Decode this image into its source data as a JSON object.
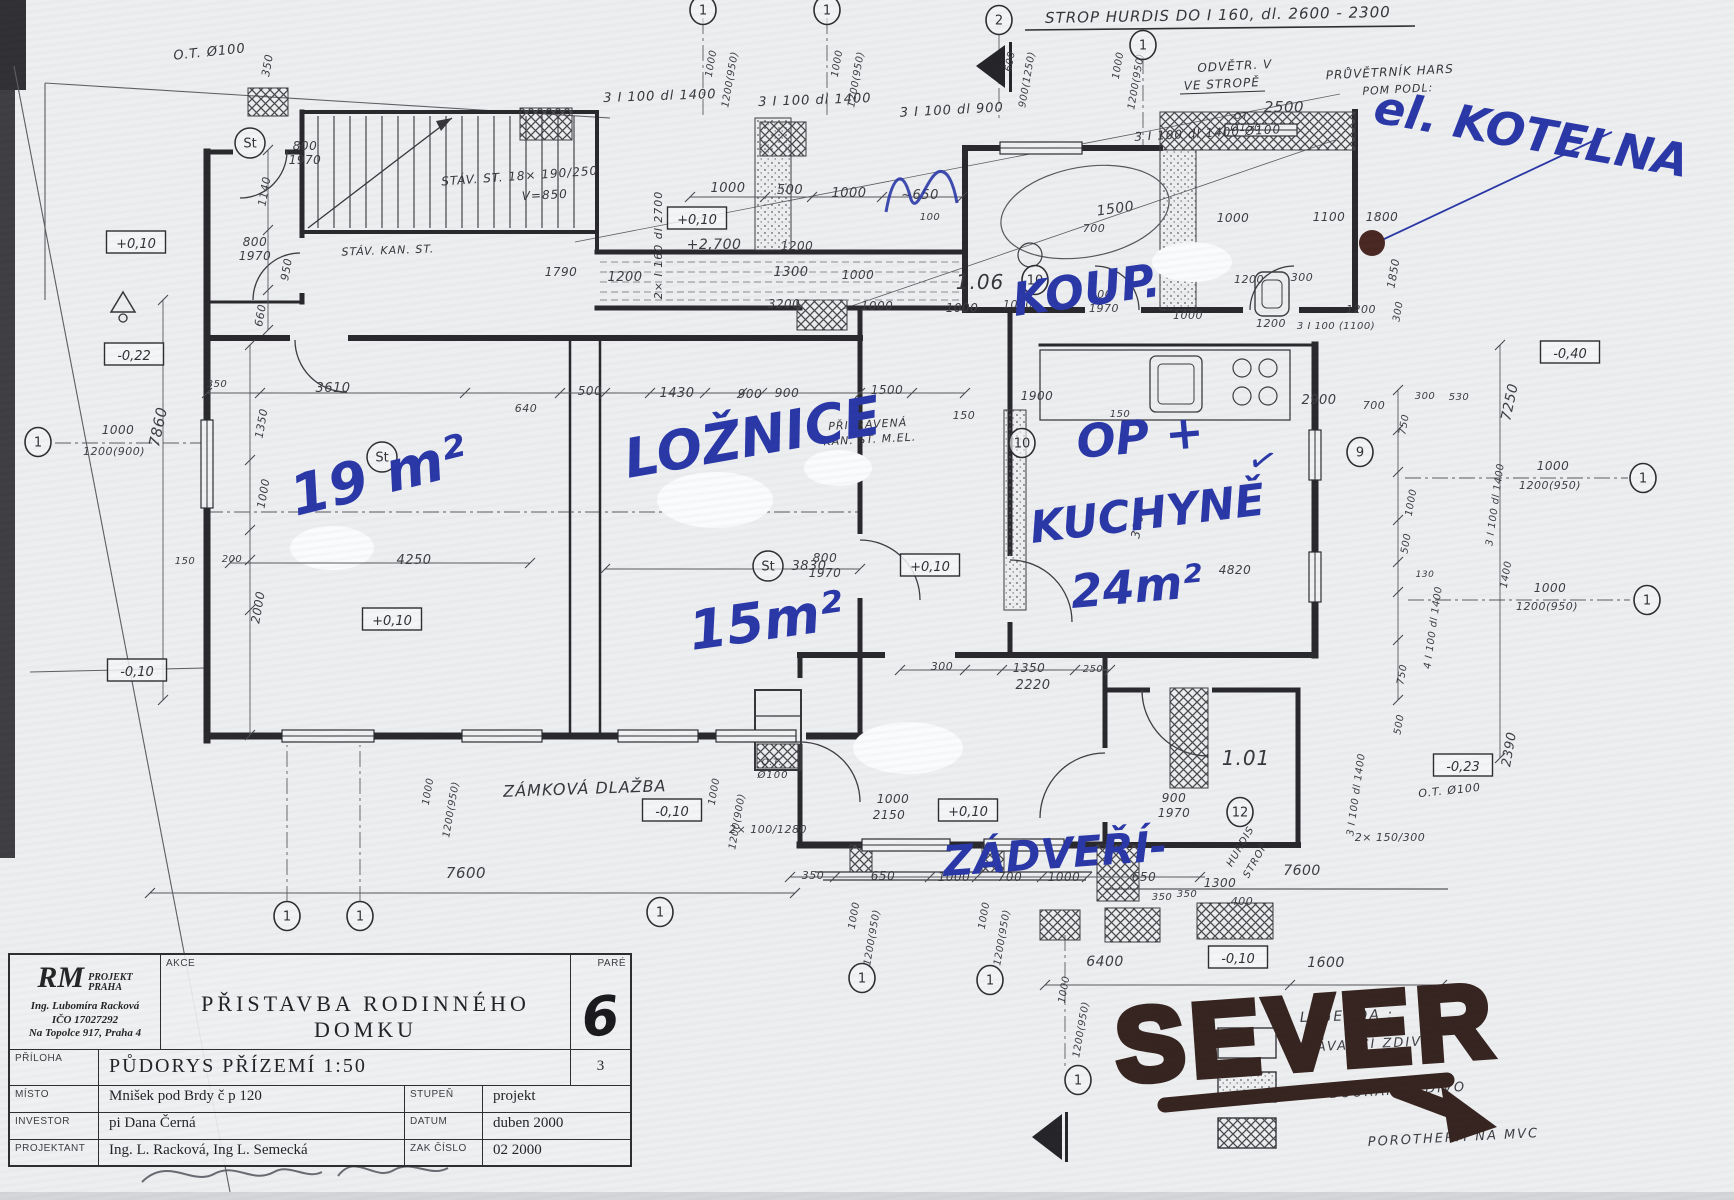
{
  "title_block": {
    "brand_r": "RM",
    "brand_top": "PROJEKT",
    "brand_bottom": "PRAHA",
    "logo_line1": "Ing. Lubomíra Racková",
    "logo_line2": "IČO 17027292",
    "logo_line3": "Na Topolce 917, Praha 4",
    "akce_label": "AKCE",
    "akce_value": "PŘISTAVBA RODINNÉHO DOMKU",
    "pare_label": "PARÉ",
    "pare_value": "6",
    "priloha_label": "PŘÍLOHA",
    "priloha_value": "PŮDORYS PŘÍZEMÍ 1:50",
    "priloha_number": "3",
    "misto_label": "MÍSTO",
    "misto_value": "Mnišek pod Brdy č p 120",
    "stupen_label": "STUPEŇ",
    "stupen_value": "projekt",
    "investor_label": "INVESTOR",
    "investor_value": "pi Dana Černá",
    "datum_label": "DATUM",
    "datum_value": "duben 2000",
    "projektant_label": "PROJEKTANT",
    "projektant_value": "Ing. L. Racková, Ing L. Semecká",
    "zakcislo_label": "ZAK ČÍSLO",
    "zakcislo_value": "02 2000"
  },
  "marker_black": {
    "text": "SEVER",
    "color": "#33211d"
  },
  "handwritten_blue": {
    "color": "#2735a6",
    "items": [
      {
        "t": "el. KOTELNA",
        "x": 1372,
        "y": 122,
        "r": 10,
        "s": 46
      },
      {
        "t": "KOUP.",
        "x": 1015,
        "y": 316,
        "r": -8,
        "s": 46
      },
      {
        "t": "LOŽNICE",
        "x": 628,
        "y": 478,
        "r": -10,
        "s": 54
      },
      {
        "t": "15m²",
        "x": 692,
        "y": 650,
        "r": -8,
        "s": 54
      },
      {
        "t": "19 m²",
        "x": 296,
        "y": 516,
        "r": -14,
        "s": 56
      },
      {
        "t": "OP +",
        "x": 1078,
        "y": 458,
        "r": -5,
        "s": 46
      },
      {
        "t": "KUCHYNĚ",
        "x": 1032,
        "y": 543,
        "r": -7,
        "s": 44
      },
      {
        "t": "24m²",
        "x": 1072,
        "y": 608,
        "r": -5,
        "s": 46
      },
      {
        "t": "ZÁDVEŘÍ-",
        "x": 944,
        "y": 876,
        "r": -4,
        "s": 42
      },
      {
        "t": "✓",
        "x": 1246,
        "y": 468,
        "r": 15,
        "s": 34
      }
    ]
  },
  "legend": {
    "title": "LEGENDA :",
    "items": [
      {
        "label": "STÁVAJÍCÍ ZDIVO",
        "swatch": "empty"
      },
      {
        "label": "BOURANÉ ZDIVO",
        "swatch": "dots"
      },
      {
        "label": "POROTHERM NA MVC",
        "swatch": "hatch"
      }
    ]
  },
  "st_markers": {
    "label": "St",
    "positions": [
      [
        250,
        143
      ],
      [
        382,
        457
      ],
      [
        768,
        566
      ]
    ]
  },
  "axis_markers": [
    {
      "n": "1",
      "x": 703,
      "y": 10
    },
    {
      "n": "1",
      "x": 827,
      "y": 10
    },
    {
      "n": "2",
      "x": 999,
      "y": 20
    },
    {
      "n": "1",
      "x": 1143,
      "y": 45
    },
    {
      "n": "1",
      "x": 38,
      "y": 442
    },
    {
      "n": "1",
      "x": 1643,
      "y": 478
    },
    {
      "n": "1",
      "x": 1647,
      "y": 600
    },
    {
      "n": "10",
      "x": 1035,
      "y": 280
    },
    {
      "n": "10",
      "x": 1022,
      "y": 443
    },
    {
      "n": "9",
      "x": 1360,
      "y": 452
    },
    {
      "n": "12",
      "x": 1240,
      "y": 812
    },
    {
      "n": "1",
      "x": 287,
      "y": 916
    },
    {
      "n": "1",
      "x": 360,
      "y": 916
    },
    {
      "n": "1",
      "x": 660,
      "y": 912
    },
    {
      "n": "1",
      "x": 862,
      "y": 978
    },
    {
      "n": "1",
      "x": 990,
      "y": 980
    },
    {
      "n": "1",
      "x": 1078,
      "y": 1080
    }
  ],
  "levels": [
    {
      "t": "+0,10",
      "x": 136,
      "y": 244
    },
    {
      "t": "+0,10",
      "x": 697,
      "y": 220
    },
    {
      "t": "+0,10",
      "x": 392,
      "y": 621
    },
    {
      "t": "+0,10",
      "x": 930,
      "y": 567
    },
    {
      "t": "+0,10",
      "x": 968,
      "y": 812
    },
    {
      "t": "-0,22",
      "x": 134,
      "y": 356
    },
    {
      "t": "-0,10",
      "x": 137,
      "y": 672
    },
    {
      "t": "-0,10",
      "x": 672,
      "y": 812
    },
    {
      "t": "-0,10",
      "x": 1238,
      "y": 959
    },
    {
      "t": "-0,40",
      "x": 1570,
      "y": 354
    },
    {
      "t": "-0,23",
      "x": 1463,
      "y": 767
    }
  ],
  "notes": [
    {
      "t": "STROP HURDIS DO I 160, dl. 2600 - 2300",
      "x": 1218,
      "y": 20,
      "r": -1,
      "s": 15
    },
    {
      "t": "ODVĚTR. V",
      "x": 1235,
      "y": 70,
      "r": -3,
      "s": 12
    },
    {
      "t": "VE STROPĚ",
      "x": 1222,
      "y": 88,
      "r": -3,
      "s": 12
    },
    {
      "t": "PRŮVĚTRNÍK HARS",
      "x": 1390,
      "y": 76,
      "r": -3,
      "s": 12
    },
    {
      "t": "POM PODL:",
      "x": 1398,
      "y": 93,
      "r": -3,
      "s": 11
    },
    {
      "t": "3 I 100 dl 1400 Ø100",
      "x": 1208,
      "y": 137,
      "r": -3,
      "s": 12
    },
    {
      "t": "3 I 100 dl 1400",
      "x": 660,
      "y": 100,
      "r": -2,
      "s": 13
    },
    {
      "t": "3 I 100 dl 1400",
      "x": 815,
      "y": 104,
      "r": -2,
      "s": 13
    },
    {
      "t": "3 I 100 dl 900",
      "x": 952,
      "y": 114,
      "r": -3,
      "s": 13
    },
    {
      "t": "O.T. Ø100",
      "x": 210,
      "y": 56,
      "r": -6,
      "s": 13
    },
    {
      "t": "OT:",
      "x": 1243,
      "y": 119,
      "r": 0,
      "s": 9
    },
    {
      "t": "Ø150",
      "x": 1246,
      "y": 131,
      "r": 0,
      "s": 10
    },
    {
      "t": "STÁV. KAN. ST.",
      "x": 388,
      "y": 254,
      "r": -2,
      "s": 11
    },
    {
      "t": "STÁV. ST. 18× 190/250",
      "x": 520,
      "y": 180,
      "r": -4,
      "s": 12
    },
    {
      "t": "V=850",
      "x": 545,
      "y": 199,
      "r": -3,
      "s": 12
    },
    {
      "t": "2× I 160 dl 2700",
      "x": 662,
      "y": 245,
      "r": -90,
      "s": 11
    },
    {
      "t": "PŘIPRAVENÁ",
      "x": 868,
      "y": 428,
      "r": -3,
      "s": 11
    },
    {
      "t": "KAN. ST. M.EL.",
      "x": 870,
      "y": 443,
      "r": -3,
      "s": 11
    },
    {
      "t": "ZÁMKOVÁ DLAŽBA",
      "x": 585,
      "y": 794,
      "r": -2,
      "s": 16
    },
    {
      "t": "1.06",
      "x": 980,
      "y": 289,
      "r": 0,
      "s": 20
    },
    {
      "t": "1.01",
      "x": 1246,
      "y": 765,
      "r": 0,
      "s": 20
    },
    {
      "t": "HURDIS",
      "x": 1243,
      "y": 848,
      "r": -60,
      "s": 10
    },
    {
      "t": "STROP",
      "x": 1258,
      "y": 862,
      "r": -60,
      "s": 10
    },
    {
      "t": "O.T.",
      "x": 772,
      "y": 765,
      "r": 0,
      "s": 9
    },
    {
      "t": "Ø100",
      "x": 773,
      "y": 778,
      "r": 0,
      "s": 10
    },
    {
      "t": "O.T. Ø100",
      "x": 1450,
      "y": 794,
      "r": -6,
      "s": 11
    }
  ],
  "dimensions": [
    {
      "t": "350",
      "x": 271,
      "y": 66,
      "r": -80,
      "s": 11
    },
    {
      "t": "800",
      "x": 305,
      "y": 150,
      "r": 0,
      "s": 12
    },
    {
      "t": "1970",
      "x": 305,
      "y": 164,
      "r": 0,
      "s": 12
    },
    {
      "t": "1140",
      "x": 268,
      "y": 192,
      "r": -80,
      "s": 11
    },
    {
      "t": "800",
      "x": 255,
      "y": 246,
      "r": 0,
      "s": 12
    },
    {
      "t": "1970",
      "x": 255,
      "y": 260,
      "r": 0,
      "s": 12
    },
    {
      "t": "950",
      "x": 290,
      "y": 270,
      "r": -80,
      "s": 11
    },
    {
      "t": "660",
      "x": 264,
      "y": 316,
      "r": -80,
      "s": 11
    },
    {
      "t": "1000",
      "x": 714,
      "y": 64,
      "r": -80,
      "s": 10
    },
    {
      "t": "1200(950)",
      "x": 733,
      "y": 80,
      "r": -80,
      "s": 10
    },
    {
      "t": "1000",
      "x": 840,
      "y": 64,
      "r": -80,
      "s": 10
    },
    {
      "t": "1200(950)",
      "x": 859,
      "y": 80,
      "r": -80,
      "s": 10
    },
    {
      "t": "600",
      "x": 1013,
      "y": 62,
      "r": -80,
      "s": 10
    },
    {
      "t": "900(1250)",
      "x": 1030,
      "y": 80,
      "r": -80,
      "s": 10
    },
    {
      "t": "1000",
      "x": 1121,
      "y": 66,
      "r": -80,
      "s": 10
    },
    {
      "t": "1200(950)",
      "x": 1139,
      "y": 82,
      "r": -80,
      "s": 10
    },
    {
      "t": "2500",
      "x": 1284,
      "y": 112,
      "r": 0,
      "s": 15
    },
    {
      "t": "1000",
      "x": 728,
      "y": 192,
      "r": 0,
      "s": 13
    },
    {
      "t": "500",
      "x": 790,
      "y": 194,
      "r": 0,
      "s": 13
    },
    {
      "t": "1000",
      "x": 849,
      "y": 197,
      "r": 0,
      "s": 13
    },
    {
      "t": "~650",
      "x": 920,
      "y": 199,
      "r": 0,
      "s": 13
    },
    {
      "t": "100",
      "x": 930,
      "y": 220,
      "r": 0,
      "s": 10
    },
    {
      "t": "+2,700",
      "x": 714,
      "y": 249,
      "r": 0,
      "s": 14
    },
    {
      "t": "1790",
      "x": 561,
      "y": 276,
      "r": 0,
      "s": 12
    },
    {
      "t": "1200",
      "x": 625,
      "y": 281,
      "r": 0,
      "s": 13
    },
    {
      "t": "1300",
      "x": 791,
      "y": 276,
      "r": 0,
      "s": 13
    },
    {
      "t": "1000",
      "x": 858,
      "y": 279,
      "r": 0,
      "s": 12
    },
    {
      "t": "1200",
      "x": 797,
      "y": 250,
      "r": 0,
      "s": 12
    },
    {
      "t": "3200",
      "x": 784,
      "y": 308,
      "r": 0,
      "s": 12
    },
    {
      "t": "1000",
      "x": 877,
      "y": 310,
      "r": 0,
      "s": 12
    },
    {
      "t": "1000",
      "x": 962,
      "y": 312,
      "r": 0,
      "s": 12
    },
    {
      "t": "1500",
      "x": 1116,
      "y": 213,
      "r": -8,
      "s": 14
    },
    {
      "t": "700",
      "x": 1094,
      "y": 232,
      "r": 0,
      "s": 11
    },
    {
      "t": "1000",
      "x": 1233,
      "y": 222,
      "r": 0,
      "s": 12
    },
    {
      "t": "1100",
      "x": 1329,
      "y": 221,
      "r": 0,
      "s": 12
    },
    {
      "t": "1800",
      "x": 1382,
      "y": 221,
      "r": 0,
      "s": 12
    },
    {
      "t": "1850",
      "x": 1397,
      "y": 274,
      "r": -80,
      "s": 11
    },
    {
      "t": "600",
      "x": 1101,
      "y": 298,
      "r": 0,
      "s": 11
    },
    {
      "t": "1970",
      "x": 1104,
      "y": 312,
      "r": 0,
      "s": 11
    },
    {
      "t": "1000",
      "x": 1018,
      "y": 308,
      "r": 0,
      "s": 11
    },
    {
      "t": "1000",
      "x": 1188,
      "y": 319,
      "r": 0,
      "s": 11
    },
    {
      "t": "1200",
      "x": 1271,
      "y": 327,
      "r": 0,
      "s": 11
    },
    {
      "t": "1200",
      "x": 1249,
      "y": 283,
      "r": 0,
      "s": 11
    },
    {
      "t": "300",
      "x": 1302,
      "y": 281,
      "r": 0,
      "s": 11
    },
    {
      "t": "1200",
      "x": 1361,
      "y": 313,
      "r": 0,
      "s": 11
    },
    {
      "t": "3 I 100 (1100)",
      "x": 1336,
      "y": 329,
      "r": 0,
      "s": 10
    },
    {
      "t": "300",
      "x": 1401,
      "y": 312,
      "r": -80,
      "s": 10
    },
    {
      "t": "900",
      "x": 787,
      "y": 397,
      "r": 0,
      "s": 12
    },
    {
      "t": "1500",
      "x": 887,
      "y": 394,
      "r": 0,
      "s": 12
    },
    {
      "t": "150",
      "x": 964,
      "y": 419,
      "r": 0,
      "s": 11
    },
    {
      "t": "350",
      "x": 217,
      "y": 387,
      "r": 0,
      "s": 10
    },
    {
      "t": "3610",
      "x": 333,
      "y": 392,
      "r": 0,
      "s": 13
    },
    {
      "t": "640",
      "x": 526,
      "y": 412,
      "r": 0,
      "s": 11
    },
    {
      "t": "500",
      "x": 590,
      "y": 395,
      "r": 0,
      "s": 12
    },
    {
      "t": "1430",
      "x": 677,
      "y": 397,
      "r": 0,
      "s": 13
    },
    {
      "t": "900",
      "x": 750,
      "y": 398,
      "r": 0,
      "s": 12
    },
    {
      "t": "7860",
      "x": 163,
      "y": 428,
      "r": -78,
      "s": 15
    },
    {
      "t": "1350",
      "x": 265,
      "y": 424,
      "r": -80,
      "s": 11
    },
    {
      "t": "1000",
      "x": 267,
      "y": 494,
      "r": -80,
      "s": 11
    },
    {
      "t": "1000",
      "x": 118,
      "y": 434,
      "r": 0,
      "s": 12
    },
    {
      "t": "1200(900)",
      "x": 114,
      "y": 455,
      "r": 0,
      "s": 11
    },
    {
      "t": "150",
      "x": 185,
      "y": 564,
      "r": 0,
      "s": 10
    },
    {
      "t": "200",
      "x": 232,
      "y": 562,
      "r": 0,
      "s": 10
    },
    {
      "t": "2000",
      "x": 262,
      "y": 608,
      "r": -80,
      "s": 12
    },
    {
      "t": "4250",
      "x": 414,
      "y": 564,
      "r": 0,
      "s": 13
    },
    {
      "t": "3830",
      "x": 809,
      "y": 570,
      "r": 0,
      "s": 13
    },
    {
      "t": "800",
      "x": 825,
      "y": 562,
      "r": 0,
      "s": 12
    },
    {
      "t": "1970",
      "x": 825,
      "y": 577,
      "r": 0,
      "s": 12
    },
    {
      "t": "1900",
      "x": 1037,
      "y": 400,
      "r": 0,
      "s": 12
    },
    {
      "t": "150",
      "x": 1120,
      "y": 417,
      "r": 0,
      "s": 10
    },
    {
      "t": "2900",
      "x": 1319,
      "y": 404,
      "r": 0,
      "s": 13
    },
    {
      "t": "700",
      "x": 1374,
      "y": 409,
      "r": 0,
      "s": 11
    },
    {
      "t": "3000",
      "x": 1142,
      "y": 523,
      "r": -80,
      "s": 12
    },
    {
      "t": "4820",
      "x": 1235,
      "y": 574,
      "r": 0,
      "s": 12
    },
    {
      "t": "300",
      "x": 1425,
      "y": 399,
      "r": 0,
      "s": 10
    },
    {
      "t": "530",
      "x": 1459,
      "y": 400,
      "r": 0,
      "s": 10
    },
    {
      "t": "750",
      "x": 1407,
      "y": 425,
      "r": -80,
      "s": 10
    },
    {
      "t": "1000",
      "x": 1414,
      "y": 503,
      "r": -80,
      "s": 10
    },
    {
      "t": "500",
      "x": 1409,
      "y": 544,
      "r": -80,
      "s": 10
    },
    {
      "t": "130",
      "x": 1425,
      "y": 577,
      "r": 0,
      "s": 9
    },
    {
      "t": "1400",
      "x": 1509,
      "y": 575,
      "r": -80,
      "s": 10
    },
    {
      "t": "7250",
      "x": 1514,
      "y": 403,
      "r": -78,
      "s": 14
    },
    {
      "t": "1000",
      "x": 1553,
      "y": 470,
      "r": 0,
      "s": 12
    },
    {
      "t": "1200(950)",
      "x": 1550,
      "y": 489,
      "r": 0,
      "s": 11
    },
    {
      "t": "1000",
      "x": 1550,
      "y": 592,
      "r": 0,
      "s": 12
    },
    {
      "t": "1200(950)",
      "x": 1547,
      "y": 610,
      "r": 0,
      "s": 11
    },
    {
      "t": "3 I 100 dl 1400",
      "x": 1498,
      "y": 505,
      "r": -82,
      "s": 10
    },
    {
      "t": "4 I 100 dl 1400",
      "x": 1436,
      "y": 628,
      "r": -82,
      "s": 10
    },
    {
      "t": "750",
      "x": 1405,
      "y": 675,
      "r": -80,
      "s": 10
    },
    {
      "t": "500",
      "x": 1402,
      "y": 725,
      "r": -80,
      "s": 10
    },
    {
      "t": "2390",
      "x": 1513,
      "y": 750,
      "r": -80,
      "s": 13
    },
    {
      "t": "2× 150/300",
      "x": 1390,
      "y": 841,
      "r": 0,
      "s": 11
    },
    {
      "t": "3 I 100 dl 1400",
      "x": 1359,
      "y": 795,
      "r": -82,
      "s": 10
    },
    {
      "t": "900",
      "x": 1174,
      "y": 802,
      "r": 0,
      "s": 12
    },
    {
      "t": "1970",
      "x": 1174,
      "y": 817,
      "r": 0,
      "s": 12
    },
    {
      "t": "1300",
      "x": 1220,
      "y": 887,
      "r": 0,
      "s": 12
    },
    {
      "t": "350",
      "x": 1162,
      "y": 900,
      "r": 0,
      "s": 10
    },
    {
      "t": "400",
      "x": 1242,
      "y": 905,
      "r": 0,
      "s": 11
    },
    {
      "t": "300",
      "x": 942,
      "y": 670,
      "r": 0,
      "s": 11
    },
    {
      "t": "1350",
      "x": 1029,
      "y": 672,
      "r": 0,
      "s": 12
    },
    {
      "t": "250",
      "x": 1093,
      "y": 672,
      "r": 0,
      "s": 10
    },
    {
      "t": "2220",
      "x": 1033,
      "y": 689,
      "r": 0,
      "s": 13
    },
    {
      "t": "2× 100/1280",
      "x": 768,
      "y": 833,
      "r": 0,
      "s": 11
    },
    {
      "t": "1000",
      "x": 893,
      "y": 803,
      "r": 0,
      "s": 12
    },
    {
      "t": "2150",
      "x": 889,
      "y": 819,
      "r": 0,
      "s": 12
    },
    {
      "t": "1000",
      "x": 431,
      "y": 792,
      "r": -80,
      "s": 10
    },
    {
      "t": "1200(950)",
      "x": 454,
      "y": 810,
      "r": -80,
      "s": 10
    },
    {
      "t": "1000",
      "x": 717,
      "y": 792,
      "r": -80,
      "s": 10
    },
    {
      "t": "1200(900)",
      "x": 740,
      "y": 822,
      "r": -80,
      "s": 10
    },
    {
      "t": "7600",
      "x": 466,
      "y": 878,
      "r": 0,
      "s": 15
    },
    {
      "t": "350",
      "x": 813,
      "y": 879,
      "r": 0,
      "s": 11
    },
    {
      "t": "650",
      "x": 883,
      "y": 880,
      "r": 0,
      "s": 12
    },
    {
      "t": "1000",
      "x": 954,
      "y": 881,
      "r": 0,
      "s": 12
    },
    {
      "t": "700",
      "x": 1010,
      "y": 881,
      "r": 0,
      "s": 12
    },
    {
      "t": "1000",
      "x": 1064,
      "y": 881,
      "r": 0,
      "s": 12
    },
    {
      "t": "650",
      "x": 1144,
      "y": 881,
      "r": 0,
      "s": 12
    },
    {
      "t": "350",
      "x": 1187,
      "y": 897,
      "r": 0,
      "s": 10
    },
    {
      "t": "1000",
      "x": 857,
      "y": 916,
      "r": -80,
      "s": 10
    },
    {
      "t": "1200(950)",
      "x": 875,
      "y": 938,
      "r": -80,
      "s": 10
    },
    {
      "t": "1000",
      "x": 987,
      "y": 916,
      "r": -80,
      "s": 10
    },
    {
      "t": "1200(950)",
      "x": 1005,
      "y": 938,
      "r": -80,
      "s": 10
    },
    {
      "t": "1000",
      "x": 1067,
      "y": 990,
      "r": -80,
      "s": 10
    },
    {
      "t": "1200(950)",
      "x": 1084,
      "y": 1030,
      "r": -80,
      "s": 10
    },
    {
      "t": "6400",
      "x": 1105,
      "y": 966,
      "r": 0,
      "s": 14
    },
    {
      "t": "1600",
      "x": 1326,
      "y": 967,
      "r": 0,
      "s": 14
    },
    {
      "t": "7600",
      "x": 1302,
      "y": 875,
      "r": 0,
      "s": 14
    }
  ]
}
